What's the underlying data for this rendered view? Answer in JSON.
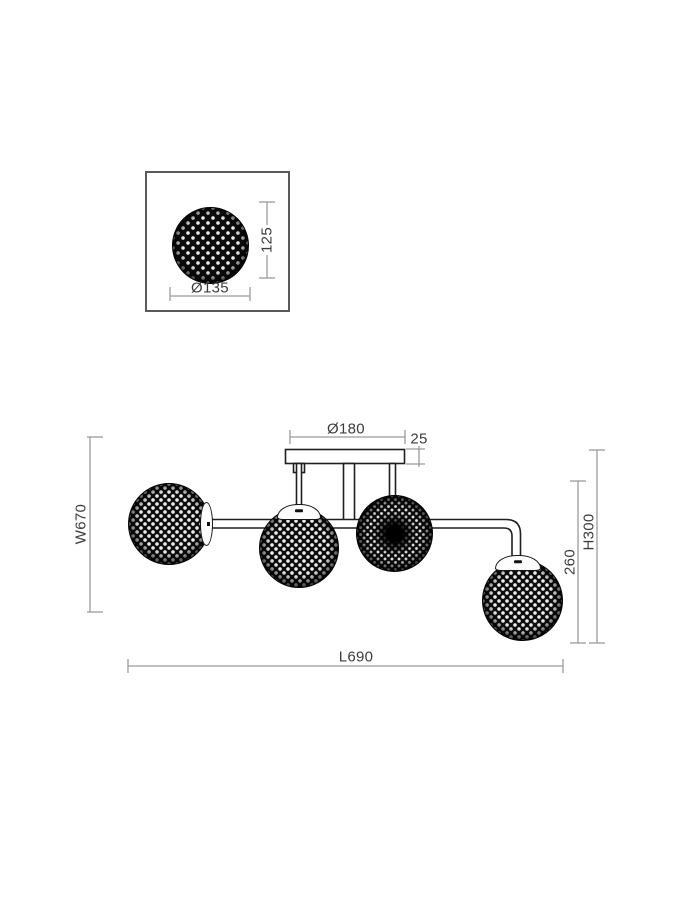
{
  "drawing": {
    "title": "four-globe ceiling lamp dimension drawing",
    "detail_view": {
      "shade_diameter": "Ø135",
      "shade_height": "125"
    },
    "main_view": {
      "canopy_diameter": "Ø180",
      "canopy_height": "25",
      "fixture_width": "W670",
      "fixture_total_height": "H300",
      "drop_height": "260",
      "fixture_length": "L690"
    }
  },
  "colors": {
    "background": "#ffffff",
    "dimension_line": "#9b9b9b",
    "dimension_text": "#3c3c3c",
    "fixture_line": "#1f1f1f",
    "globe_fill": "#0d0d0d"
  }
}
